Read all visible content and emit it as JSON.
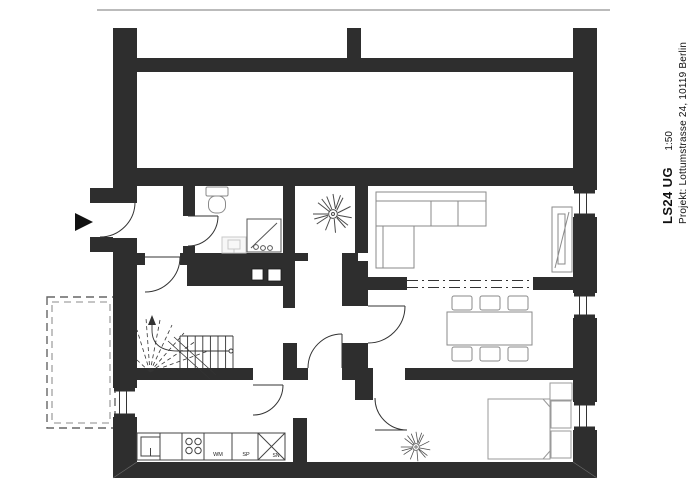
{
  "title_block": {
    "project_code": "LS24 UG",
    "scale": "1:50",
    "project_line": "Projekt: Lottumstrasse 24, 10119 Berlin"
  },
  "plan": {
    "floor": "UG",
    "kitchen": {
      "unit_labels": [
        "WM",
        "SP",
        "SN"
      ]
    },
    "colors": {
      "wall": "#2e2e2e",
      "line": "#333333",
      "furniture_outline": "#8a8a8a",
      "light_fixture": "#cccccc",
      "background": "#ffffff"
    }
  }
}
